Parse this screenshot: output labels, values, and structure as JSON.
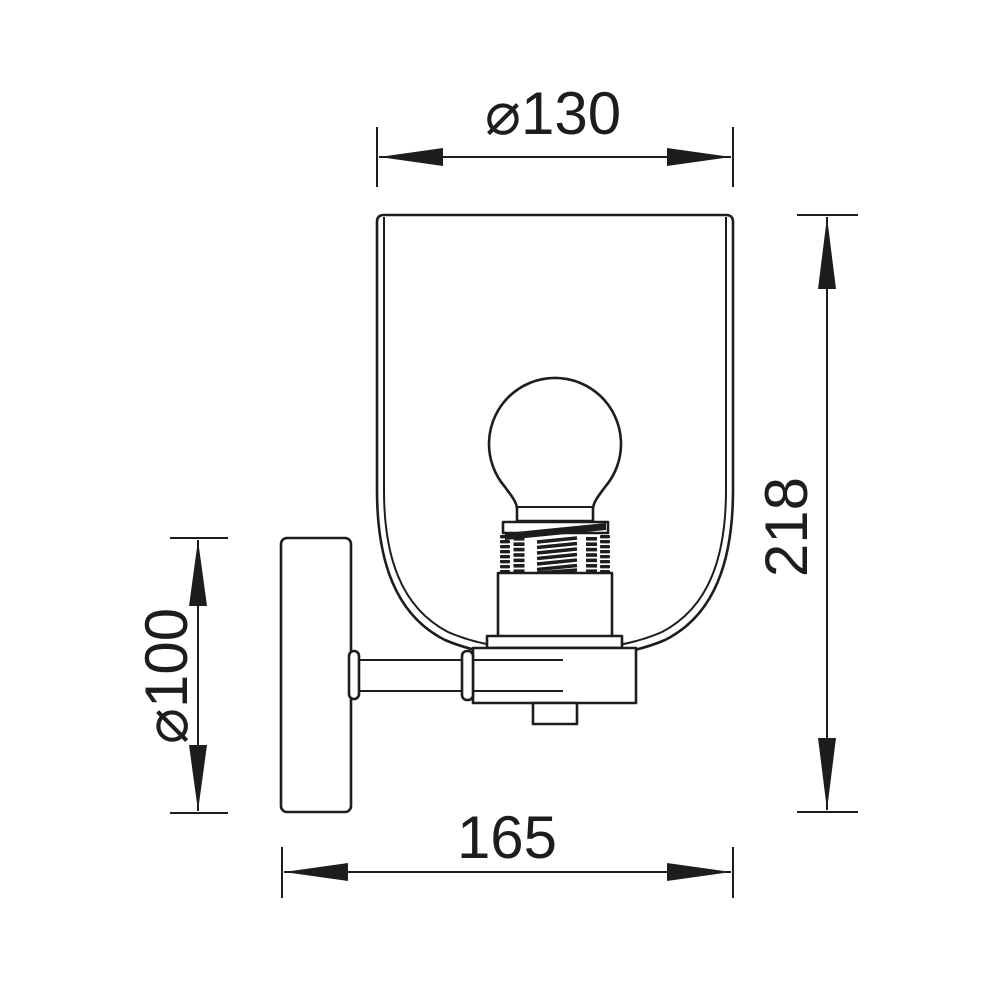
{
  "page": {
    "background": "#ffffff",
    "line_color": "#1d1d1b"
  },
  "diagram": {
    "type": "technical-dimension-drawing",
    "subject": "wall sconce light fixture, side elevation",
    "unit": "mm",
    "dimensions": {
      "shade_diameter": {
        "label": "⌀130",
        "value": 130,
        "axis": "horizontal",
        "position": "top",
        "measures": "glass shade outer diameter"
      },
      "total_height": {
        "label": "218",
        "value": 218,
        "axis": "vertical",
        "position": "right",
        "measures": "overall fixture height"
      },
      "backplate_diameter": {
        "label": "⌀100",
        "value": 100,
        "axis": "vertical",
        "position": "left",
        "measures": "wall plate diameter"
      },
      "depth": {
        "label": "165",
        "value": 165,
        "axis": "horizontal",
        "position": "bottom",
        "measures": "projection from wall"
      }
    },
    "components": [
      "glass-shade",
      "light-bulb",
      "bulb-socket",
      "socket-threads",
      "socket-flange",
      "lamp-holder-box",
      "junction-box",
      "mounting-arm",
      "wall-plate"
    ]
  }
}
